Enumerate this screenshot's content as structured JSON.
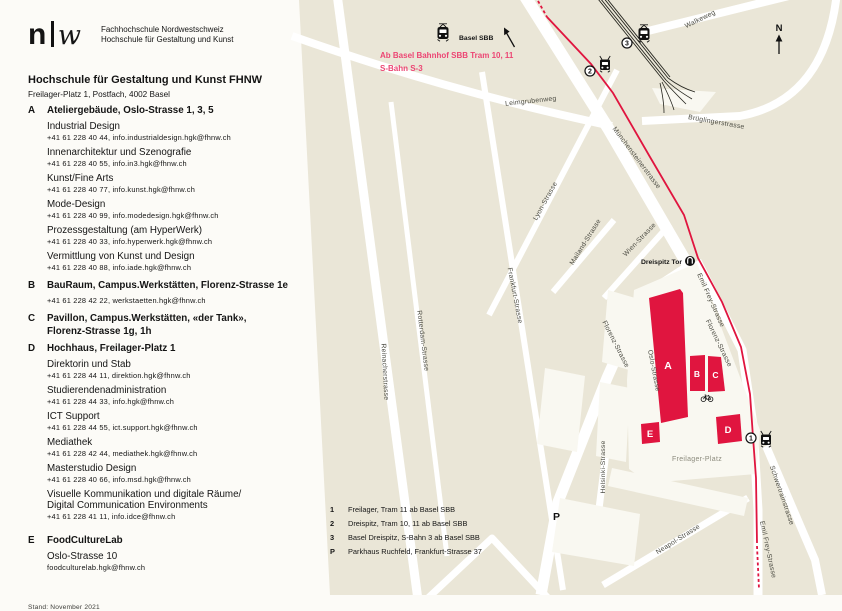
{
  "logo": {
    "mark_n": "n",
    "mark_w": "w",
    "org_line1": "Fachhochschule Nordwestschweiz",
    "org_line2": "Hochschule für Gestaltung und Kunst"
  },
  "header": {
    "title": "Hochschule für Gestaltung und Kunst FHNW",
    "address": "Freilager-Platz 1, Postfach, 4002  Basel"
  },
  "directory": {
    "a": {
      "letter": "A",
      "title": "Ateliergebäude, Oslo-Strasse 1, 3, 5",
      "entries": [
        {
          "name": "Industrial Design",
          "contact": "+41 61 228 40 44, info.industrialdesign.hgk@fhnw.ch"
        },
        {
          "name": "Innenarchitektur und Szenografie",
          "contact": "+41 61 228 40 55, info.in3.hgk@fhnw.ch"
        },
        {
          "name": "Kunst/Fine Arts",
          "contact": "+41 61 228 40 77, info.kunst.hgk@fhnw.ch"
        },
        {
          "name": "Mode-Design",
          "contact": "+41 61 228 40 99, info.modedesign.hgk@fhnw.ch"
        },
        {
          "name": "Prozessgestaltung (am HyperWerk)",
          "contact": "+41 61 228 40 33, info.hyperwerk.hgk@fhnw.ch"
        },
        {
          "name": "Vermittlung von Kunst und Design",
          "contact": "+41 61 228 40 88, info.iade.hgk@fhnw.ch"
        }
      ]
    },
    "b": {
      "letter": "B",
      "title": "BauRaum, Campus.Werkstätten, Florenz-Strasse 1e",
      "contact": "+41 61 228 42 22, werkstaetten.hgk@fhnw.ch"
    },
    "c": {
      "letter": "C",
      "title_line1": "Pavillon, Campus.Werkstätten, «der Tank»,",
      "title_line2": "Florenz-Strasse 1g, 1h"
    },
    "d": {
      "letter": "D",
      "title": "Hochhaus, Freilager-Platz 1",
      "entries": [
        {
          "name": "Direktorin und Stab",
          "contact": "+41 61 228 44 11, direktion.hgk@fhnw.ch"
        },
        {
          "name": "Studierendenadministration",
          "contact": "+41 61 228 44 33, info.hgk@fhnw.ch"
        },
        {
          "name": "ICT Support",
          "contact": "+41 61 228 44 55, ict.support.hgk@fhnw.ch"
        },
        {
          "name": "Mediathek",
          "contact": "+41 61 228 42 44, mediathek.hgk@fhnw.ch"
        },
        {
          "name": "Masterstudio Design",
          "contact": "+41 61 228 40 66, info.msd.hgk@fhnw.ch"
        },
        {
          "name": "Visuelle Kommunikation und digitale Räume/",
          "name2": "Digital Communication Environments",
          "contact": "+41 61 228 41 11, info.idce@fhnw.ch"
        }
      ]
    },
    "e": {
      "letter": "E",
      "title": "FoodCultureLab",
      "address": "Oslo-Strasse 10",
      "contact": "foodculturelab.hgk@fhnw.ch"
    },
    "stand": "Stand: November 2021"
  },
  "map": {
    "colors": {
      "red": "#e0153f",
      "pink": "#ec4573",
      "beige": "#eae6d7",
      "road": "#ffffff",
      "building_light": "#f9f8f1"
    },
    "station_label": "Basel SBB",
    "route_note_line1": "Ab Basel Bahnhof SBB Tram 10, 11",
    "route_note_line2": "S-Bahn S-3",
    "north_label": "N",
    "parking_label": "P",
    "buildings": [
      {
        "letter": "A"
      },
      {
        "letter": "B"
      },
      {
        "letter": "C"
      },
      {
        "letter": "D"
      },
      {
        "letter": "E"
      }
    ],
    "stops": [
      {
        "num": "1"
      },
      {
        "num": "2"
      },
      {
        "num": "3"
      }
    ],
    "streets": {
      "walkeweg": "Walkeweg",
      "leimgrubenweg": "Leimgrubenweg",
      "bruglingerstrasse": "Brüglingerstrasse",
      "muenchensteinerstrasse": "Münchensteinerstrasse",
      "mailand": "Mailand-Strasse",
      "wien": "Wien-Strasse",
      "lyon": "Lyon-Strasse",
      "frankfurt": "Frankfurt-Strasse",
      "reinacher": "Reinacherstrasse",
      "rotterdam": "Rotterdam-Strasse",
      "florenz": "Florenz-Strasse",
      "emil_frey": "Emil Frey-Strasse",
      "oslo": "Oslo-Strasse",
      "helsinki": "Helsinki-Strasse",
      "neapol": "Neapol-Strasse",
      "schwertrain": "Schwertrainstrasse",
      "freilager_platz": "Freilager-Platz",
      "dreispitz_tor": "Dreispitz Tor"
    },
    "legend": [
      {
        "key": "1",
        "text": "Freilager, Tram 11 ab Basel SBB"
      },
      {
        "key": "2",
        "text": "Dreispitz, Tram 10, 11 ab Basel SBB"
      },
      {
        "key": "3",
        "text": "Basel Dreispitz, S-Bahn 3 ab Basel SBB"
      },
      {
        "key": "P",
        "text": "Parkhaus Ruchfeld, Frankfurt-Strasse 37"
      }
    ]
  }
}
